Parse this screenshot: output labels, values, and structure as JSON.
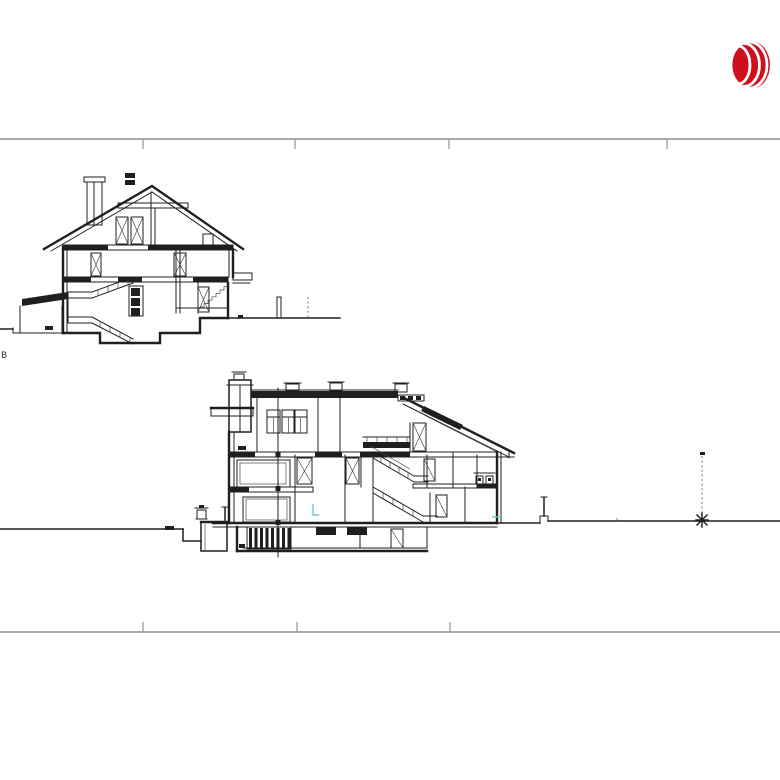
{
  "colors": {
    "paper": "#ffffff",
    "ink": "#1f1f1f",
    "frame": "#ababab",
    "frametick": "#9a9a9a",
    "logored": "#cf101c",
    "teal": "#6cc9cc",
    "dashcol": "#777777"
  },
  "sheet": {
    "section_marker": "B"
  },
  "logo": {
    "name": "jll-oval-mark",
    "color": "#cf101c"
  }
}
